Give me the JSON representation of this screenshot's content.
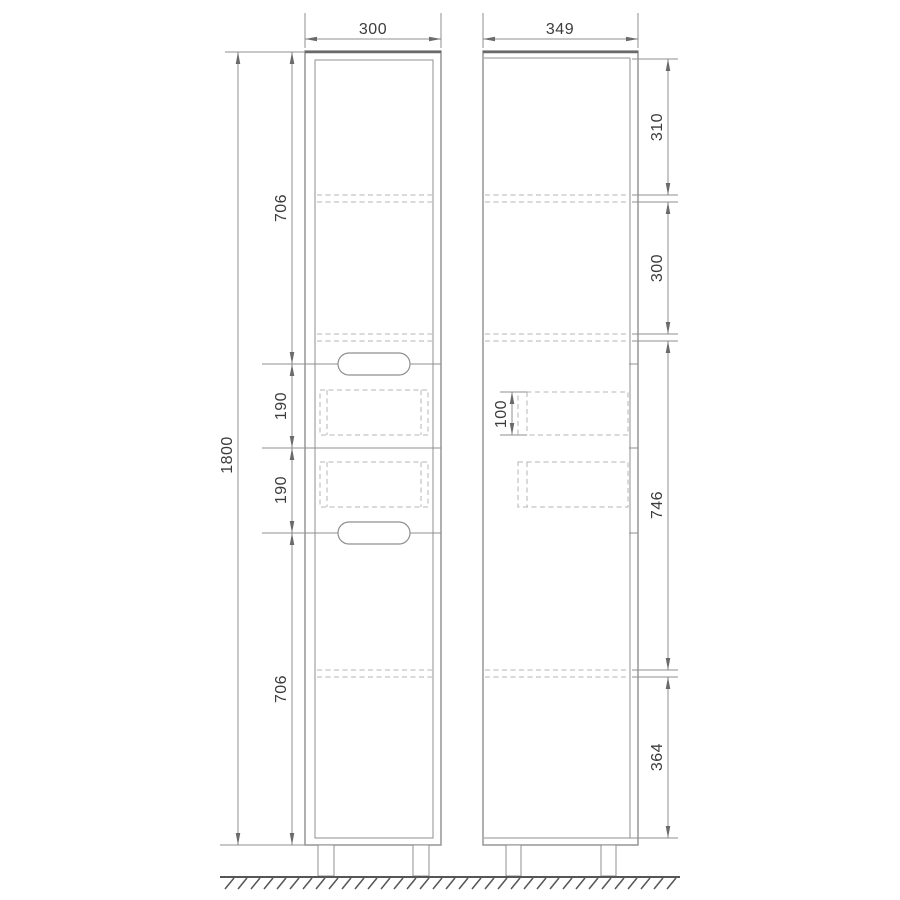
{
  "drawing_type": "cabinet-technical-drawing",
  "views": {
    "front": {
      "width": "300",
      "height": "1800",
      "heights": [
        "706",
        "190",
        "190",
        "706"
      ]
    },
    "side": {
      "depth": "349",
      "sections": [
        "310",
        "300",
        "746",
        "364"
      ],
      "drawer_front_height": "100"
    }
  },
  "colors": {
    "line": "#8f8f8f",
    "dark": "#6a6a6a",
    "dash": "#b5b5b5",
    "text": "#3c3c3c",
    "ground": "#565656",
    "bg": "#ffffff"
  }
}
